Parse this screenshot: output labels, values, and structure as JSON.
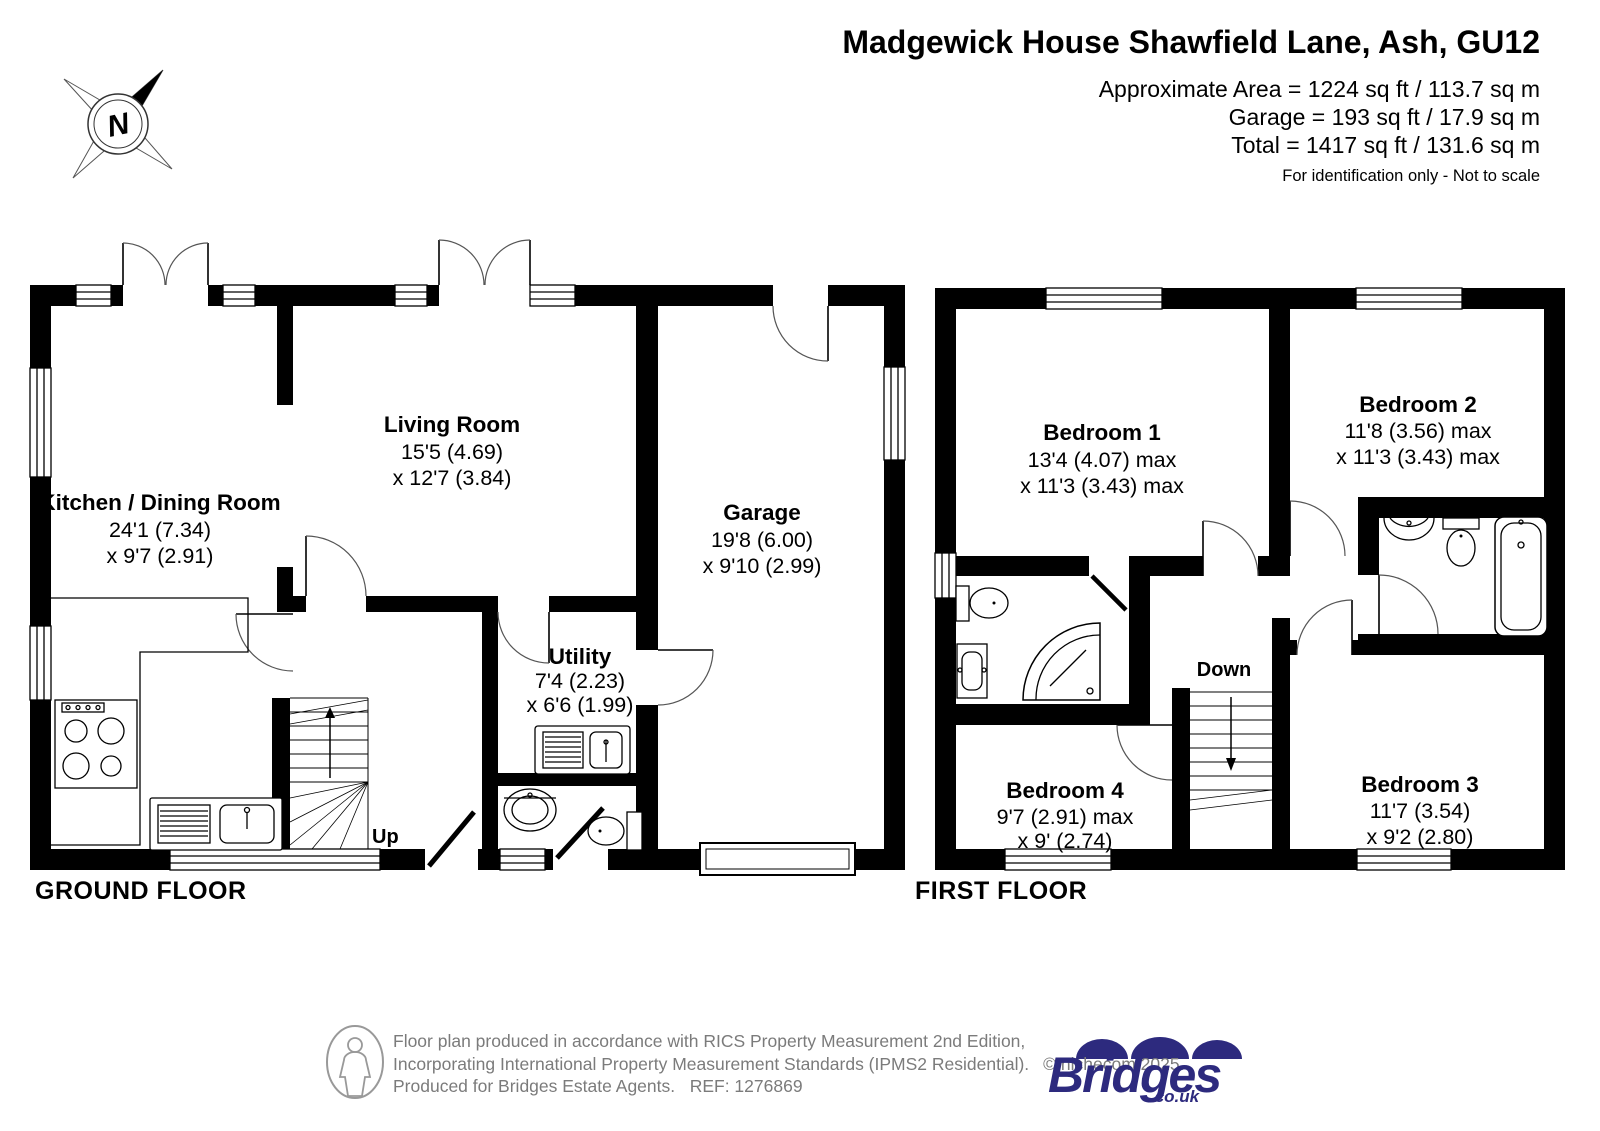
{
  "header": {
    "title": "Madgewick House Shawfield Lane, Ash, GU12",
    "area_lines": [
      "Approximate Area = 1224 sq ft / 113.7 sq m",
      "Garage = 193 sq ft / 17.9 sq m",
      "Total = 1417 sq ft / 131.6 sq m"
    ],
    "note": "For identification only - Not to scale"
  },
  "compass": {
    "north_label": "N"
  },
  "floors": {
    "ground": {
      "label": "GROUND FLOOR",
      "stairs_label": "Up",
      "rooms": {
        "kitchen": {
          "name": "Kitchen / Dining Room",
          "dim1": "24'1 (7.34)",
          "dim2": "x 9'7 (2.91)"
        },
        "living": {
          "name": "Living Room",
          "dim1": "15'5 (4.69)",
          "dim2": "x 12'7 (3.84)"
        },
        "garage": {
          "name": "Garage",
          "dim1": "19'8 (6.00)",
          "dim2": "x 9'10 (2.99)"
        },
        "utility": {
          "name": "Utility",
          "dim1": "7'4 (2.23)",
          "dim2": "x 6'6 (1.99)"
        }
      }
    },
    "first": {
      "label": "FIRST FLOOR",
      "stairs_label": "Down",
      "rooms": {
        "bedroom1": {
          "name": "Bedroom 1",
          "dim1": "13'4 (4.07) max",
          "dim2": "x 11'3 (3.43) max"
        },
        "bedroom2": {
          "name": "Bedroom 2",
          "dim1": "11'8 (3.56) max",
          "dim2": "x 11'3 (3.43) max"
        },
        "bedroom3": {
          "name": "Bedroom 3",
          "dim1": "11'7 (3.54)",
          "dim2": "x 9'2 (2.80)"
        },
        "bedroom4": {
          "name": "Bedroom 4",
          "dim1": "9'7 (2.91) max",
          "dim2": "x 9' (2.74)"
        }
      }
    }
  },
  "footer": {
    "line1": "Floor plan produced in accordance with RICS Property Measurement 2nd Edition,",
    "line2": "Incorporating International Property Measurement Standards (IPMS2 Residential).",
    "copyright": "© nichecom 2025.",
    "line3": "Produced for Bridges Estate Agents.   REF: 1276869",
    "logo": {
      "name": "Bridges",
      "suffix": ".co.uk",
      "color": "#2d2a7e"
    }
  },
  "colors": {
    "wall": "#000000",
    "footer_text": "#7b7b7b",
    "logo": "#2d2a7e"
  }
}
